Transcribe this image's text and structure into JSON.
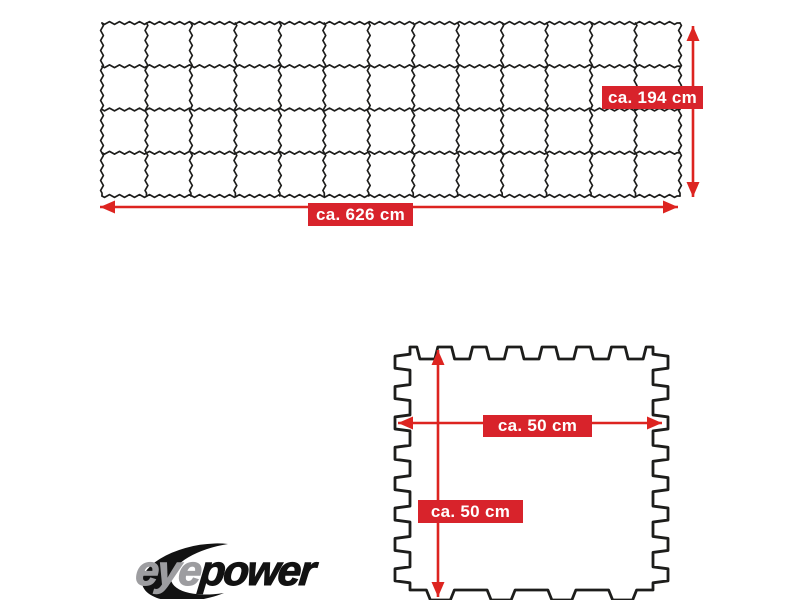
{
  "colors": {
    "background": "#ffffff",
    "label_red": "#d8232b",
    "arrow_red": "#dd2420",
    "line_black": "#1d1d1b",
    "tile_fill": "#ffffff",
    "label_text": "#ffffff",
    "logo_gray": "#9d9da0",
    "logo_black": "#121212"
  },
  "mat_layout": {
    "description": "assembled interlocking mat grid",
    "columns": 13,
    "rows": 4,
    "width_label": "ca. 626 cm",
    "height_label": "ca. 194 cm"
  },
  "single_tile": {
    "description": "single puzzle tile with interlocking edges",
    "width_label": "ca. 50 cm",
    "height_label": "ca. 50 cm",
    "top_slots": 7,
    "side_tabs": 8,
    "bottom_tabs": 4
  },
  "logo": {
    "part1": "eye",
    "part2": "power"
  }
}
